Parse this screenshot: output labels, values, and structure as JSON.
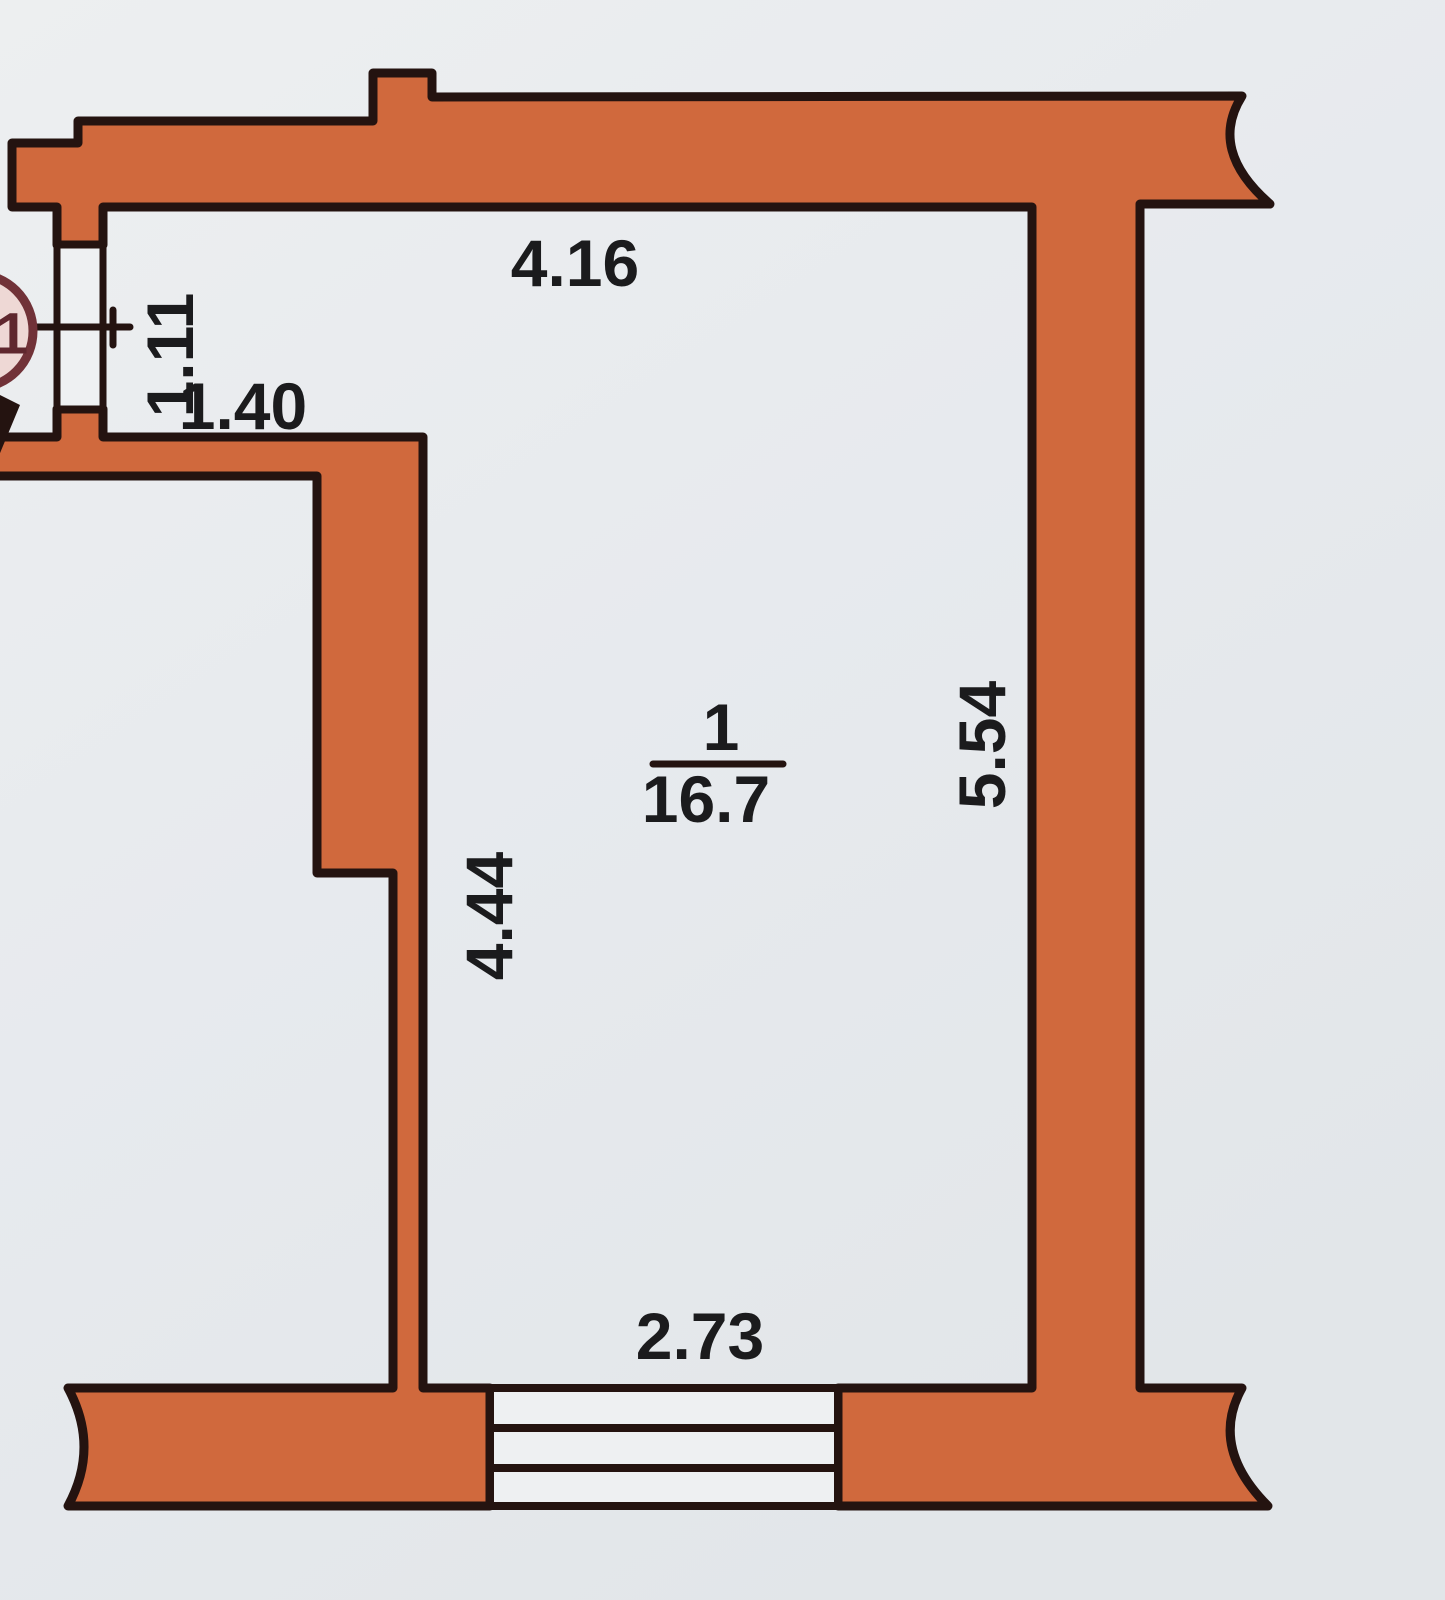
{
  "plan": {
    "type": "floor_plan",
    "room": {
      "number": "1",
      "area": "16.7"
    },
    "dimensions": {
      "top_width": "4.16",
      "left_opening": "1.11",
      "alcove_width": "1.40",
      "left_height": "4.44",
      "right_height": "5.54",
      "bottom_width": "2.73"
    },
    "axis_marker": {
      "label": "1"
    },
    "colors": {
      "wall_fill": "#d0693d",
      "wall_outline": "#241310",
      "paper": "#e8ebee",
      "opening_fill": "#eef0f2",
      "marker_stroke": "#713238",
      "marker_fill": "#eed8d5",
      "marker_text": "#5f272e",
      "dim_text": "#1b1b1d"
    }
  }
}
